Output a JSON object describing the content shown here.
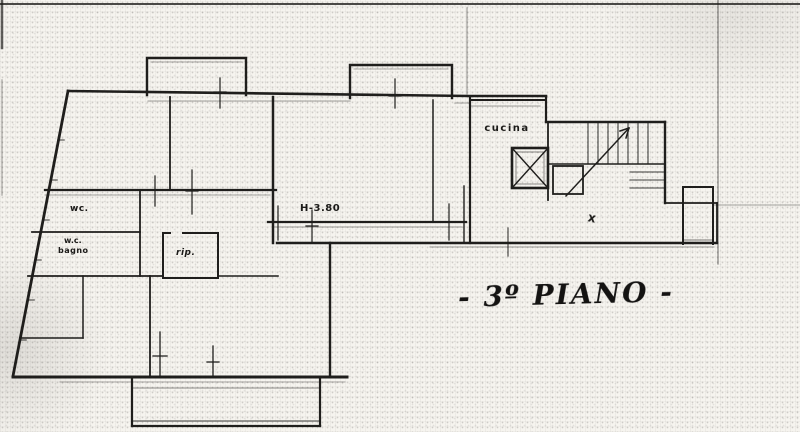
{
  "document": {
    "floor_title": "- 3º PIANO -",
    "rooms": {
      "kitchen": "cucina",
      "wc_small": "wc.",
      "wc": "w.c.",
      "bathroom": "bagno",
      "storage": "rip."
    },
    "annotations": {
      "ceiling_height": "H-3.80",
      "cross_mark": "x"
    },
    "colors": {
      "ink": "#1f1e1c",
      "paper": "#f6f4ef"
    }
  }
}
